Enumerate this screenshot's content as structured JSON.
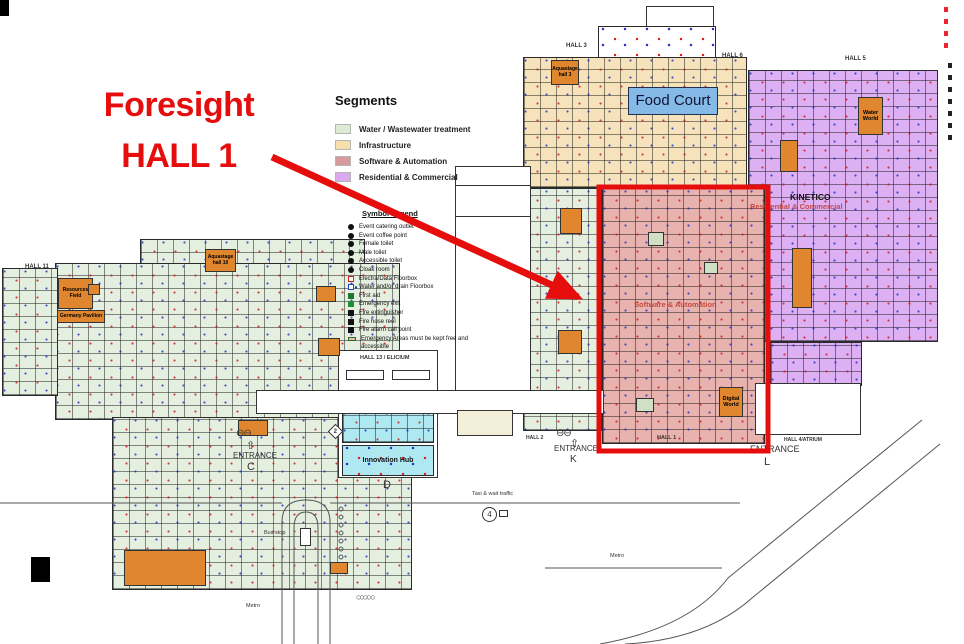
{
  "annotation": {
    "line1": "Foresight",
    "line2": "HALL 1"
  },
  "accent_red": "#e60d0d",
  "legend": {
    "segments": {
      "title": "Segments",
      "items": [
        {
          "label": "Water / Wastewater treatment",
          "color": "#ddebd5"
        },
        {
          "label": "Infrastructure",
          "color": "#f7dfad"
        },
        {
          "label": "Software & Automation",
          "color": "#d89b9b"
        },
        {
          "label": "Residential & Commercial",
          "color": "#d9aaed"
        }
      ]
    },
    "symbols": {
      "title": "Symbol Legend",
      "items": [
        {
          "label": "Event catering outlet",
          "icon": "circle",
          "color": "#111111"
        },
        {
          "label": "Event coffee point",
          "icon": "circle",
          "color": "#111111"
        },
        {
          "label": "Female toilet",
          "icon": "circle",
          "color": "#111111"
        },
        {
          "label": "Male toilet",
          "icon": "circle",
          "color": "#111111"
        },
        {
          "label": "Accessible toilet",
          "icon": "circle",
          "color": "#111111"
        },
        {
          "label": "Cloak room",
          "icon": "circle",
          "color": "#111111"
        },
        {
          "label": "Electra/Data Floorbox",
          "icon": "square-outline",
          "color": "#d42222"
        },
        {
          "label": "Water and/or drain Floorbox",
          "icon": "square-outline-dot",
          "color": "#2244cc"
        },
        {
          "label": "First aid",
          "icon": "square",
          "color": "#1a7a2a"
        },
        {
          "label": "Emergency exit",
          "icon": "square",
          "color": "#1f8f3a"
        },
        {
          "label": "Fire extinguisher",
          "icon": "square",
          "color": "#111111"
        },
        {
          "label": "Fire hose reel",
          "icon": "square",
          "color": "#111111"
        },
        {
          "label": "Fire alarm call point",
          "icon": "square",
          "color": "#111111"
        },
        {
          "label": "Emergency Areas must be kept free and accessible",
          "icon": "rect",
          "color": "#f0b8b8"
        }
      ]
    }
  },
  "halls": {
    "hall1": "HALL 1",
    "hall2": "HALL 2",
    "hall3": "HALL 3",
    "hall4": "HALL 4/ATRIUM",
    "hall5": "HALL 5",
    "hall6": "HALL 6",
    "hall11": "HALL 11",
    "hall13": "HALL 13 / ELICIUM"
  },
  "features": {
    "food_court": "Food Court",
    "innovation_hub": "Innovation Hub",
    "digital_world": "Digital World",
    "water_world": "Water World",
    "kinetico": "KINETICO",
    "aquastage3": "Aquastage hall 3",
    "aquastage10": "Aquastage hall 10",
    "resources_field": "Resources Field",
    "germany_pavilion": "Germany Pavilion",
    "software_automation": "Software & Automation",
    "residential_commercial": "Residential & Commercial"
  },
  "entrances": {
    "word": "ENTRANCE",
    "c": "C",
    "k": "K",
    "l": "L",
    "d": "D"
  },
  "transit": {
    "taxi": "Taxi & wait traffic",
    "bus_stop": "Bus stop",
    "metro_left": "Metro",
    "metro_right": "Metro",
    "route4": "4",
    "route2": "2"
  }
}
